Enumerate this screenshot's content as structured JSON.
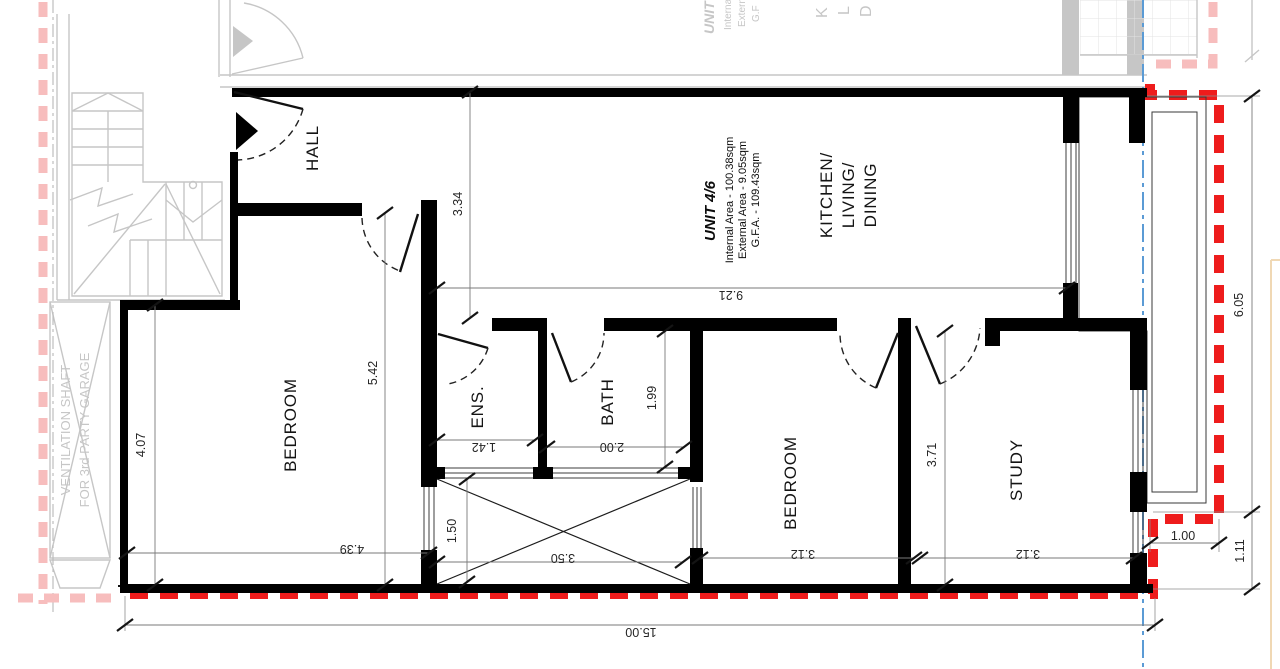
{
  "unit": {
    "name": "UNIT 4/6",
    "internal_area": "Internal Area - 100.38sqm",
    "external_area": "External Area - 9.05sqm",
    "gfa": "G.F.A. - 109.43sqm"
  },
  "rooms": {
    "hall": "HALL",
    "kitchen_living_dining": [
      "KITCHEN/",
      "LIVING/",
      "DINING"
    ],
    "bedroom_left": "BEDROOM",
    "ensuite": "ENS.",
    "bath": "BATH",
    "bedroom_right": "BEDROOM",
    "study": "STUDY"
  },
  "dimensions": {
    "total_width": "15.00",
    "living_width": "9.21",
    "living_depth": "3.34",
    "hall_bedroom_depth": "5.42",
    "bedroom_left_depth": "4.07",
    "bedroom_left_width": "4.39",
    "shaft_width": "3.50",
    "shaft_depth": "1.50",
    "ensuite_width": "1.42",
    "bath_width": "2.00",
    "bath_depth": "1.99",
    "bedroom_right_width": "3.12",
    "bedroom_right_depth": "3.71",
    "study_width": "3.12",
    "balcony_depth": "6.05",
    "terrace_step_width": "1.00",
    "terrace_step_depth": "1.11"
  },
  "context": {
    "vent_shaft_line1": "VENTILATION SHAFT",
    "vent_shaft_line2": "FOR 3rd PARTY GARAGE",
    "adjacent_unit_name": "UNIT",
    "adjacent_line1": "Interna",
    "adjacent_line2": "Extern",
    "adjacent_line3": "G.F",
    "adjacent_k": "K",
    "adjacent_l": "L",
    "adjacent_d": "D"
  },
  "colors": {
    "wall": "#000000",
    "context_gray": "#c6c6c6",
    "boundary_red": "#ee1c1c",
    "boundary_pink": "#f7bdbd",
    "grid_blue": "#5b9bd5",
    "dim": "#3a3a3a"
  }
}
